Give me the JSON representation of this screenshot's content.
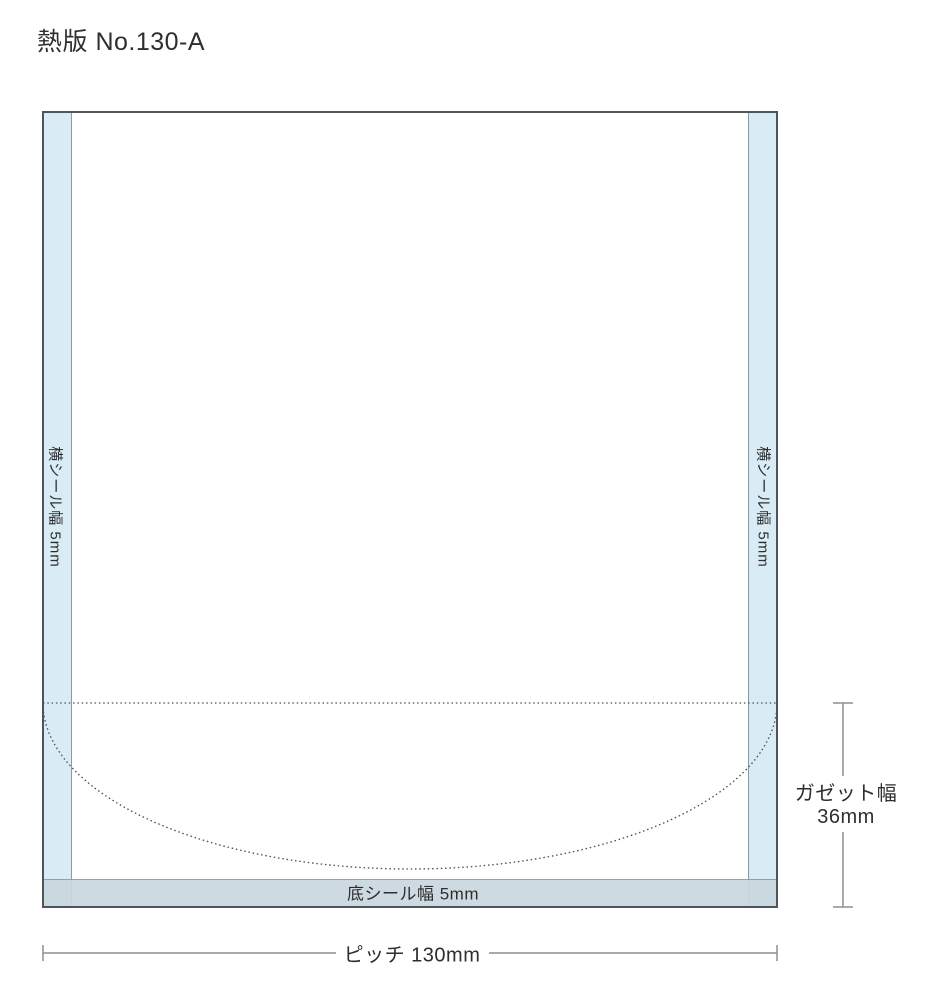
{
  "title": "熱版 No.130-A",
  "bag": {
    "side_seal_label": "横シール幅 5mm",
    "bottom_seal_label": "底シール幅 5mm"
  },
  "dimensions": {
    "gusset": {
      "label": "ガゼット幅",
      "value": "36mm"
    },
    "pitch": {
      "label": "ピッチ 130mm"
    }
  },
  "colors": {
    "side_seal_fill": "#d9ecf5",
    "bottom_seal_fill": "#c9d7df",
    "outline": "#4d545a",
    "inner_line": "#8d9aa4",
    "fold_line": "#4f4f4f",
    "dimension_line": "#8f8f8f"
  }
}
